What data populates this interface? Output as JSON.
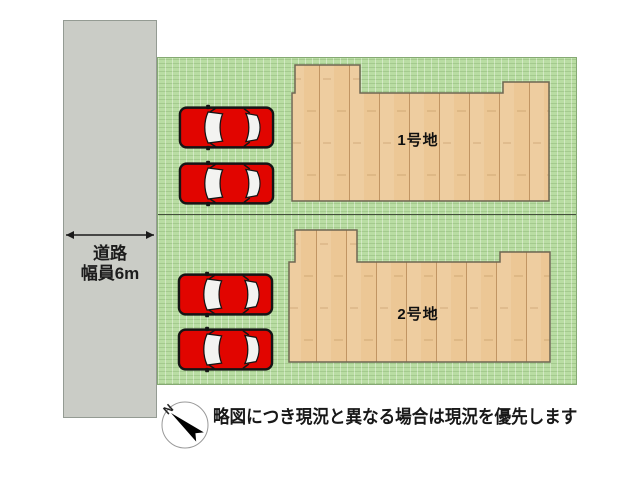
{
  "diagram": {
    "road": {
      "label_line1": "道路",
      "label_line2": "幅員6m"
    },
    "plots": [
      {
        "label": "1号地",
        "cars_parked": 2
      },
      {
        "label": "2号地",
        "cars_parked": 2
      }
    ],
    "compass": {
      "letter": "N"
    },
    "disclaimer": "略図につき現況と異なる場合は現況を優先します",
    "colors": {
      "ground": "#b9dda3",
      "building": "#ecc795",
      "road": "#caccc6",
      "car": "#e10500",
      "outline": "#6f6752"
    }
  }
}
